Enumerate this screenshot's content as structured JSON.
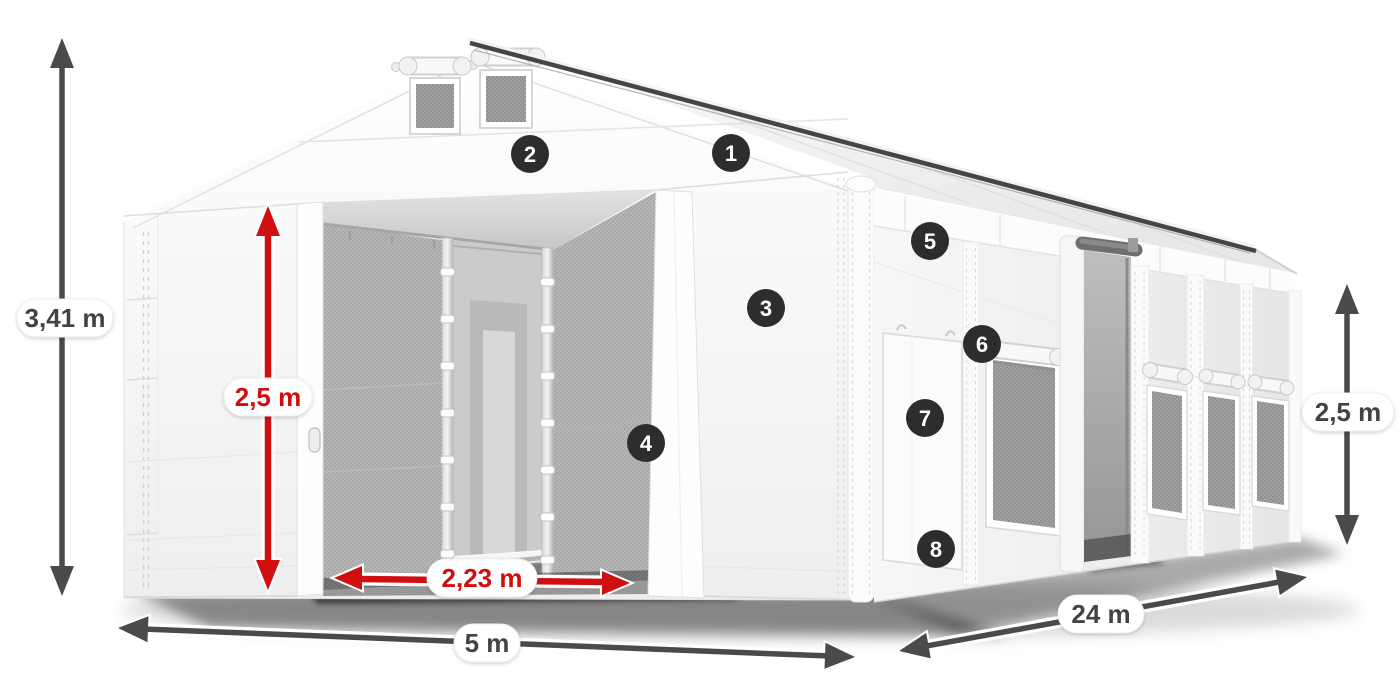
{
  "diagram": {
    "subject": "White modular storage tent shown in 3D with dimension arrows and numbered feature callouts",
    "colors": {
      "background": "#ffffff",
      "dimension_arrow_dark": "#4a4a4a",
      "dimension_text_dark": "#434343",
      "accent_red": "#d01010",
      "badge_background": "#2d2d2d",
      "badge_text": "#ffffff",
      "label_pill_background": "#ffffff",
      "tent_white": "#f7f7f7",
      "interior_gray": "#b0b0b0"
    },
    "dimensions": {
      "total_height": {
        "value": "3,41 m",
        "style": "dark"
      },
      "inner_height": {
        "value": "2,5 m",
        "style": "red"
      },
      "entrance_width": {
        "value": "2,23 m",
        "style": "red"
      },
      "width": {
        "value": "5 m",
        "style": "dark"
      },
      "length": {
        "value": "24 m",
        "style": "dark"
      },
      "side_height": {
        "value": "2,5 m",
        "style": "dark"
      }
    },
    "callouts": [
      {
        "number": "1"
      },
      {
        "number": "2"
      },
      {
        "number": "3"
      },
      {
        "number": "4"
      },
      {
        "number": "5"
      },
      {
        "number": "6"
      },
      {
        "number": "7"
      },
      {
        "number": "8"
      }
    ]
  }
}
